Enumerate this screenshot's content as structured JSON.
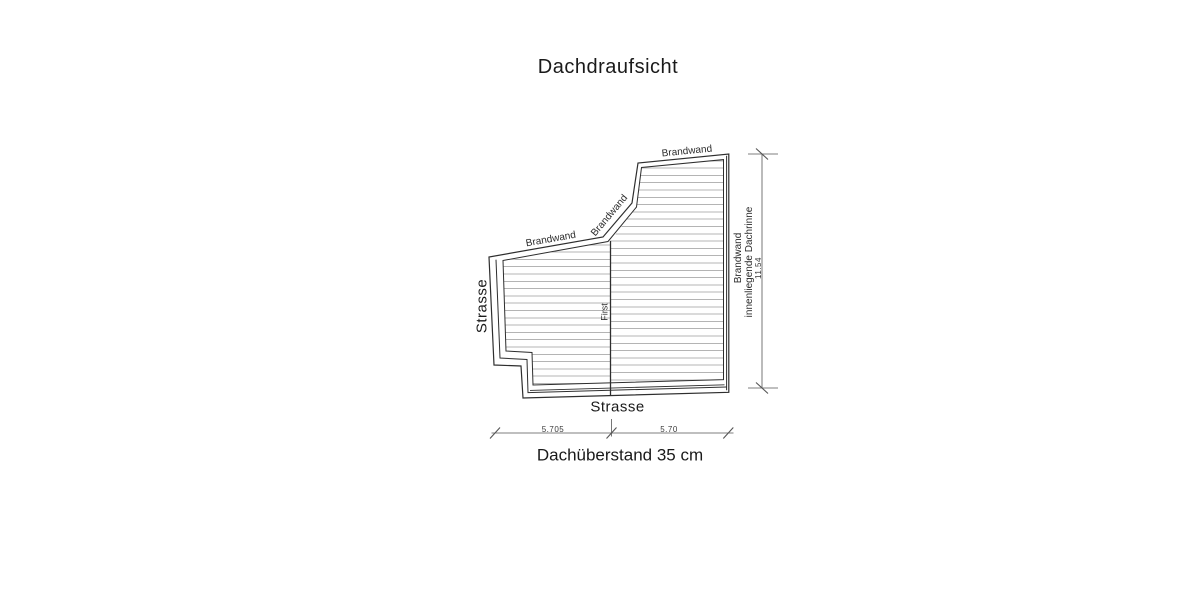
{
  "title": "Dachdraufsicht",
  "drawing": {
    "labels": {
      "brandwand_top": "Brandwand",
      "brandwand_diagonal": "Brandwand",
      "brandwand_left": "Brandwand",
      "brandwand_right": "Brandwand",
      "dachrinne_right": "innenliegende Dachrinne",
      "street_left": "Strasse",
      "street_bottom": "Strasse",
      "ridge": "First"
    },
    "dimensions": {
      "width_left": "5.705",
      "width_right": "5.70",
      "height_right": "11.54",
      "overhang_note": "Dachüberstand 35 cm"
    },
    "colors": {
      "line": "#2e2e2e",
      "hatch": "#b4b4b4",
      "dimension": "#555555",
      "background": "#ffffff"
    }
  }
}
